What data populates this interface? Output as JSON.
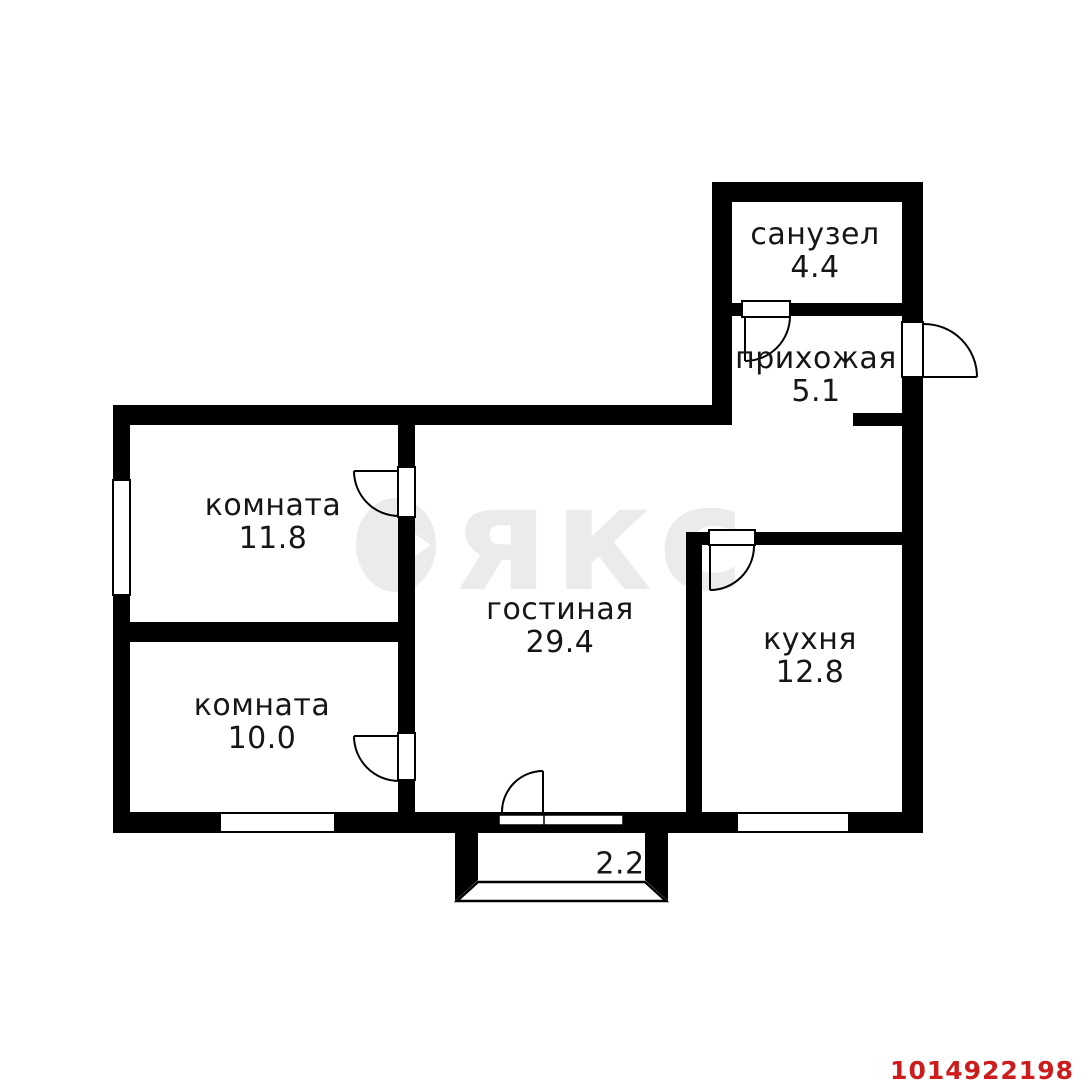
{
  "plan": {
    "rooms": [
      {
        "name": "санузел",
        "area": "4.4"
      },
      {
        "name": "прихожая",
        "area": "5.1"
      },
      {
        "name": "комната",
        "area": "11.8"
      },
      {
        "name": "комната",
        "area": "10.0"
      },
      {
        "name": "гостиная",
        "area": "29.4"
      },
      {
        "name": "кухня",
        "area": "12.8"
      }
    ],
    "balcony_area": "2.2"
  },
  "watermark": {
    "brand": "аякс",
    "text_suffix": "якс"
  },
  "listing_id": "1014922198",
  "colors": {
    "walls": "#000000",
    "watermark": "#ebebeb",
    "listing_id_red": "#cd1c1c",
    "background": "#ffffff"
  }
}
